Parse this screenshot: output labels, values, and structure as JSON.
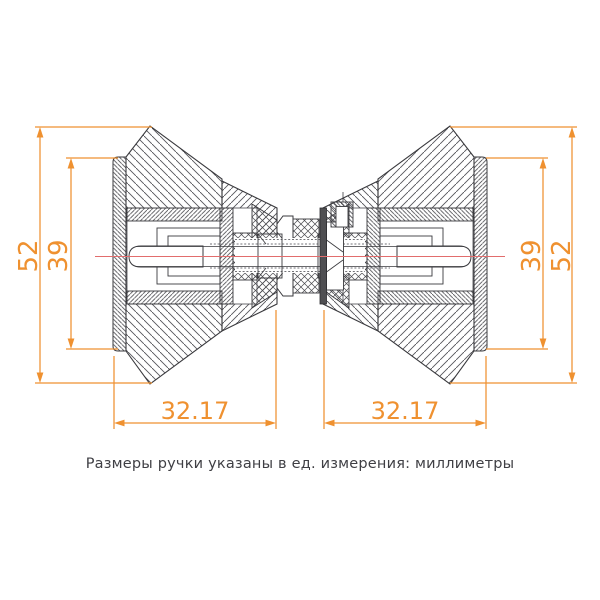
{
  "page": {
    "background": "#ffffff"
  },
  "colors": {
    "dimension_orange": "#ef9130",
    "centerline_red": "#e26d6d",
    "outline_gray": "#3a3a3e",
    "hatch_gray": "#55555a",
    "gasket_dark": "#4f4f52",
    "note_text": "#3f3f44"
  },
  "dims": {
    "left_outer": "52",
    "left_inner": "39",
    "right_inner": "39",
    "right_outer": "52",
    "bottom_left": "32.17",
    "bottom_right": "32.17"
  },
  "note": {
    "text": "Размеры ручки указаны в ед. измерения: миллиметры"
  }
}
